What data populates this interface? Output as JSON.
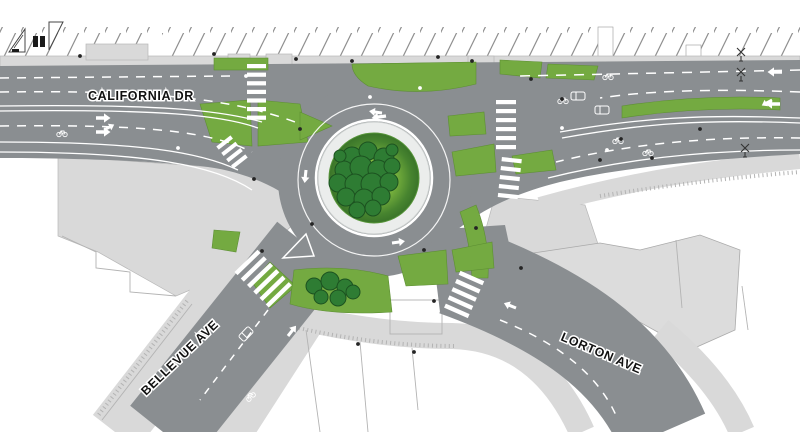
{
  "title": "Roundabout street plan",
  "streets": [
    {
      "name": "CALIFORNIA DR"
    },
    {
      "name": "BELLEVUE AVE"
    },
    {
      "name": "LORTON AVE"
    }
  ],
  "palette": {
    "road": "#8a8e91",
    "sidewalk": "#d9d9d9",
    "building": "#dcdcdc",
    "green": "#74aa41",
    "green_edge": "#5d8f33",
    "tree": "#2e7c33",
    "tree_edge": "#1c5220",
    "island_light": "#c3dd55",
    "island_mid": "#7cb53e",
    "island_dark": "#3a7429",
    "apron": "#ebedec",
    "marking": "#ffffff",
    "hatch": "#8f8f8f",
    "label": "#111111"
  },
  "icons": [
    "tree-icon",
    "bike-lane-marking-icon",
    "car-marking-icon",
    "railroad-crossbuck-icon",
    "crossing-gate-icon",
    "street-light-icon",
    "crosswalk-stripes",
    "lane-arrow-icon"
  ]
}
